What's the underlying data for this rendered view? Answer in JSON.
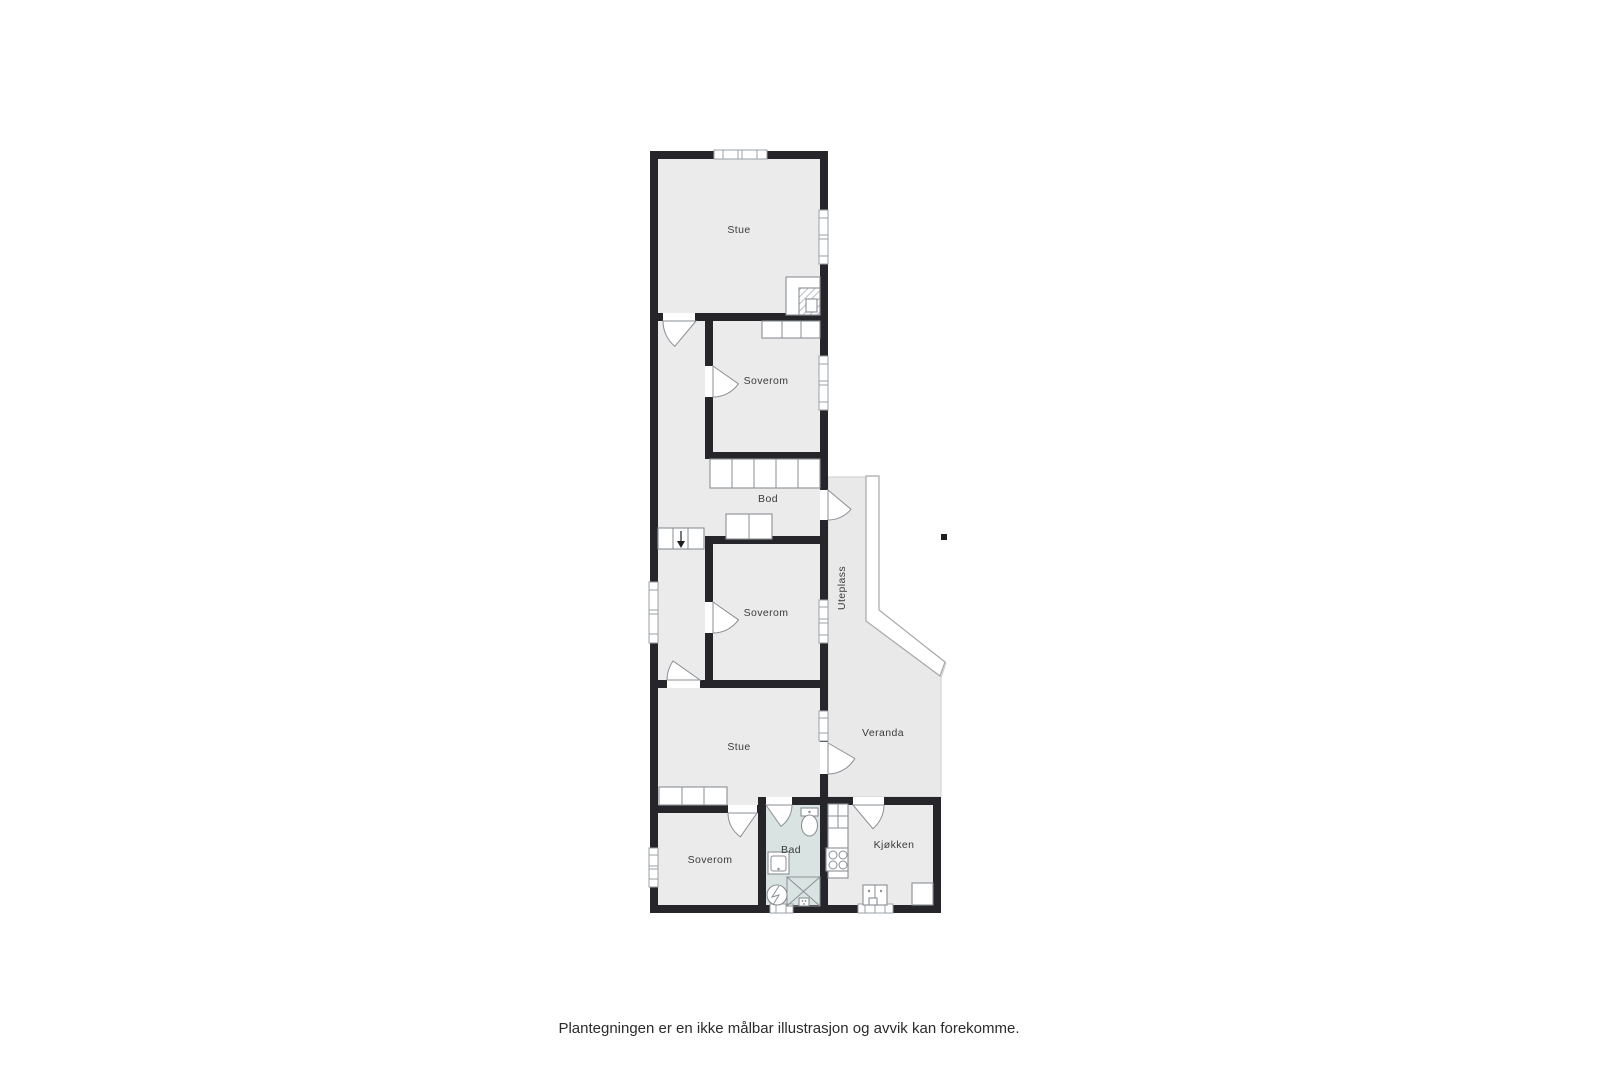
{
  "floorplan": {
    "rooms": [
      {
        "id": "stue-1",
        "label": "Stue"
      },
      {
        "id": "soverom-1",
        "label": "Soverom"
      },
      {
        "id": "bod",
        "label": "Bod"
      },
      {
        "id": "soverom-2",
        "label": "Soverom"
      },
      {
        "id": "uteplass",
        "label": "Uteplass"
      },
      {
        "id": "stue-2",
        "label": "Stue"
      },
      {
        "id": "veranda",
        "label": "Veranda"
      },
      {
        "id": "soverom-3",
        "label": "Soverom"
      },
      {
        "id": "bad",
        "label": "Bad"
      },
      {
        "id": "kjokken",
        "label": "Kjøkken"
      }
    ],
    "fixtures": [
      "window",
      "door-swing",
      "fireplace",
      "wardrobe",
      "shelving",
      "stairs-down",
      "cabinet",
      "toilet",
      "bathroom-sink",
      "washing-machine",
      "shower",
      "kitchen-counter",
      "stove",
      "kitchen-sink",
      "railing",
      "position-marker"
    ],
    "colors": {
      "wall": "#26262a",
      "room_fill": "#ebebeb",
      "outdoor_fill": "#e9e9e9",
      "bathroom_fill": "#d9e4e2",
      "fixture_stroke": "#8a8f94",
      "marker": "#1e1e1e",
      "text": "#3b3b3b"
    }
  },
  "caption": {
    "text": "Plantegningen er en ikke målbar illustrasjon og avvik kan forekomme."
  }
}
